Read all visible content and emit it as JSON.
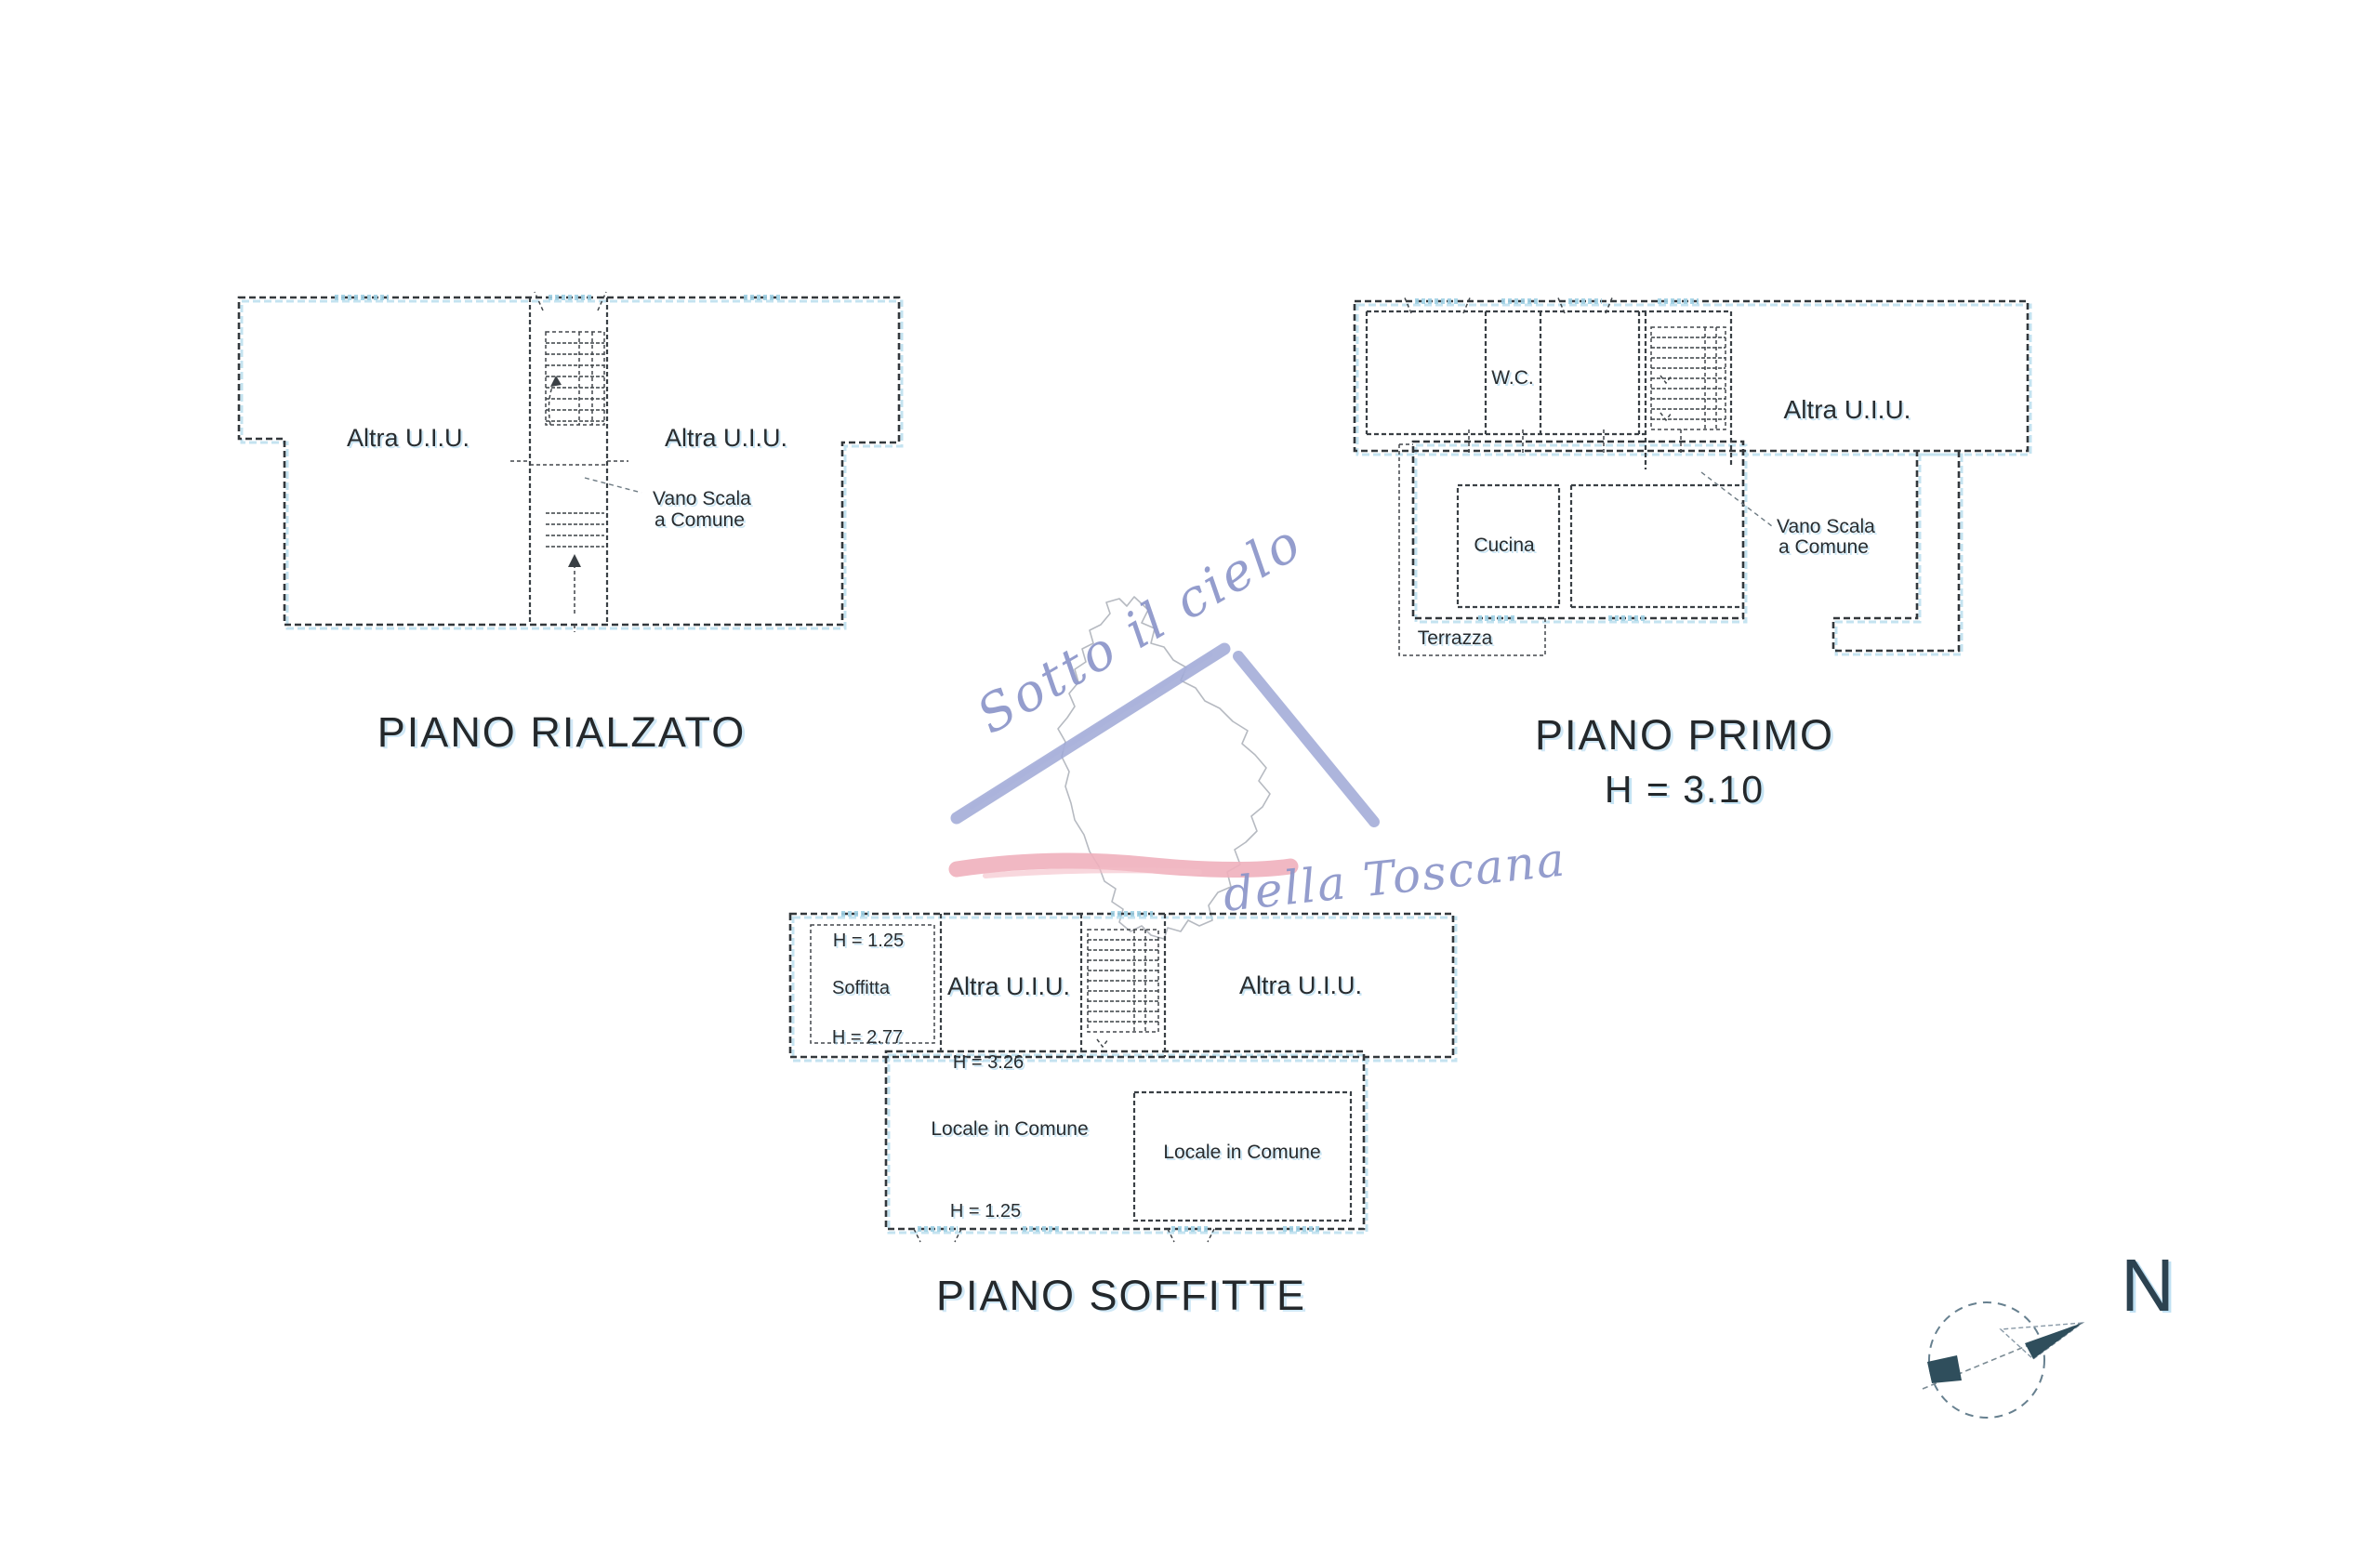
{
  "watermark": {
    "line1": "Sotto il cielo",
    "line2": "della Toscana"
  },
  "floors": {
    "rialzato": {
      "title": "PIANO RIALZATO",
      "unit_left": "Altra U.I.U.",
      "unit_right": "Altra U.I.U.",
      "stairwell_line1": "Vano Scala",
      "stairwell_line2": "a Comune"
    },
    "primo": {
      "title": "PIANO PRIMO",
      "height_note": "H = 3.10",
      "wc": "W.C.",
      "unit": "Altra U.I.U.",
      "kitchen": "Cucina",
      "stairwell_line1": "Vano Scala",
      "stairwell_line2": "a Comune",
      "terrace": "Terrazza"
    },
    "soffitte": {
      "title": "PIANO SOFFITTE",
      "height_top": "H = 1.25",
      "attic": "Soffitta",
      "height_mid": "H = 2.77",
      "unit_left": "Altra U.I.U.",
      "unit_right": "Altra U.I.U.",
      "height_middle_room": "H = 3.26",
      "common_left": "Locale in Comune",
      "common_right": "Locale in Comune",
      "height_bottom": "H = 1.25"
    }
  },
  "compass": {
    "north_label": "N"
  },
  "colors": {
    "ink": "#33383c",
    "scan_fringe": "#b5dcec",
    "watermark_text": "#8b95c9",
    "roof_stroke": "#9fa8d6",
    "underline_stroke": "#f0b0bd",
    "map_outline": "#a9aeb6",
    "compass_fill": "#2f4e5c"
  }
}
